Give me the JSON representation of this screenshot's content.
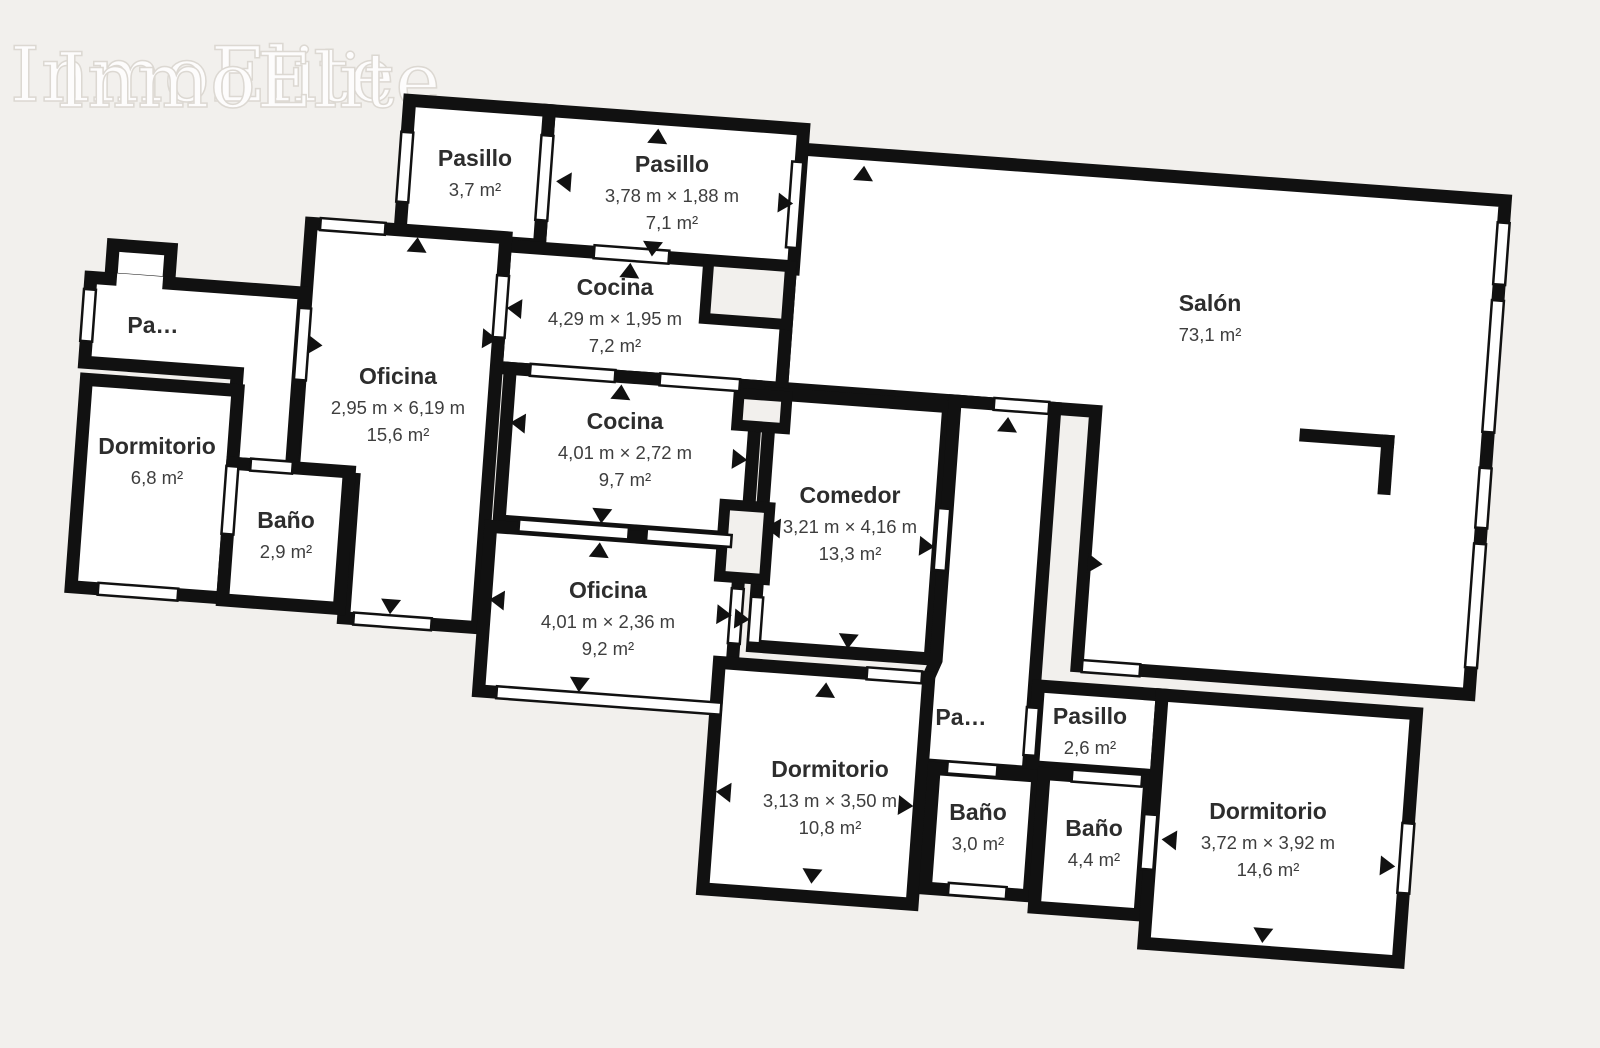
{
  "watermark": {
    "text": "InmoElite"
  },
  "colors": {
    "background": "#f2f0ed",
    "wall": "#111111",
    "room_fill": "#ffffff",
    "label_text": "#2d2d2d",
    "detail_text": "#3e3e3e"
  },
  "rooms": [
    {
      "id": "pasillo-top-left",
      "name": "Pasillo",
      "dims": "",
      "area": "3,7 m²"
    },
    {
      "id": "pasillo-top",
      "name": "Pasillo",
      "dims": "3,78 m × 1,88 m",
      "area": "7,1 m²"
    },
    {
      "id": "cocina-top",
      "name": "Cocina",
      "dims": "4,29 m × 1,95 m",
      "area": "7,2 m²"
    },
    {
      "id": "oficina-left",
      "name": "Oficina",
      "dims": "2,95 m × 6,19 m",
      "area": "15,6 m²"
    },
    {
      "id": "pasillo-entry",
      "name": "Pa…",
      "dims": "",
      "area": ""
    },
    {
      "id": "dormitorio-left",
      "name": "Dormitorio",
      "dims": "",
      "area": "6,8 m²"
    },
    {
      "id": "bano-left",
      "name": "Baño",
      "dims": "",
      "area": "2,9 m²"
    },
    {
      "id": "cocina-mid",
      "name": "Cocina",
      "dims": "4,01 m × 2,72 m",
      "area": "9,7 m²"
    },
    {
      "id": "oficina-mid",
      "name": "Oficina",
      "dims": "4,01 m × 2,36 m",
      "area": "9,2 m²"
    },
    {
      "id": "comedor",
      "name": "Comedor",
      "dims": "3,21 m × 4,16 m",
      "area": "13,3 m²"
    },
    {
      "id": "salon",
      "name": "Salón",
      "dims": "",
      "area": "73,1 m²"
    },
    {
      "id": "dormitorio-mid",
      "name": "Dormitorio",
      "dims": "3,13 m × 3,50 m",
      "area": "10,8 m²"
    },
    {
      "id": "pasillo-flare",
      "name": "Pa…",
      "dims": "",
      "area": ""
    },
    {
      "id": "pasillo-bottom",
      "name": "Pasillo",
      "dims": "",
      "area": "2,6 m²"
    },
    {
      "id": "bano-mid",
      "name": "Baño",
      "dims": "",
      "area": "3,0 m²"
    },
    {
      "id": "bano-right",
      "name": "Baño",
      "dims": "",
      "area": "4,4 m²"
    },
    {
      "id": "dormitorio-right",
      "name": "Dormitorio",
      "dims": "3,72 m × 3,92 m",
      "area": "14,6 m²"
    }
  ]
}
